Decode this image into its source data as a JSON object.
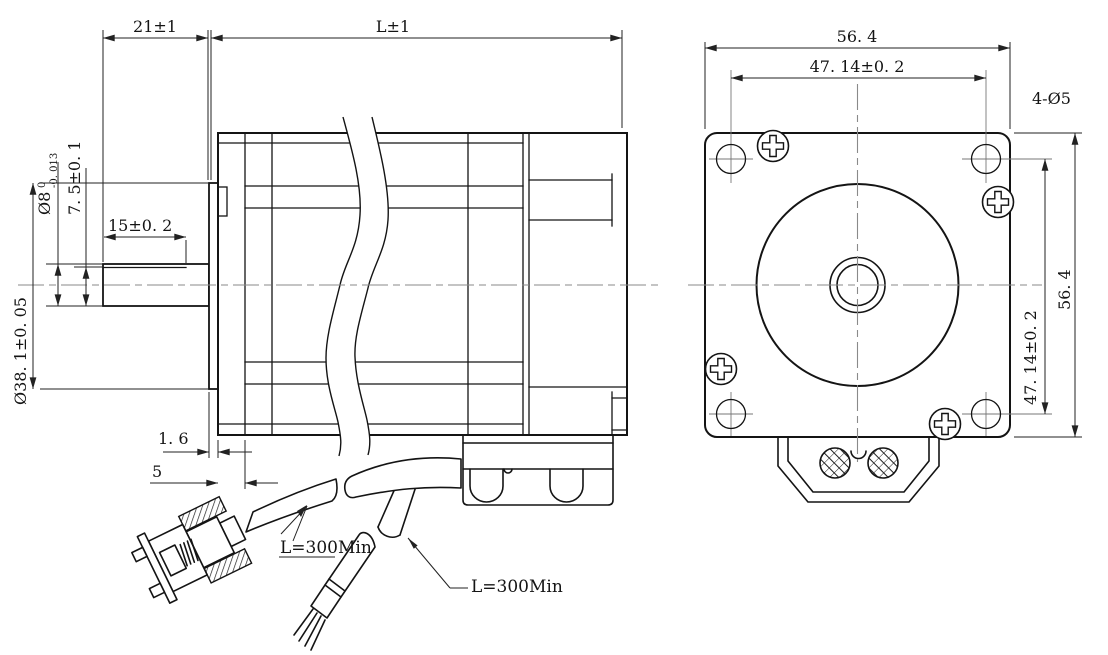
{
  "drawing": {
    "type": "stepper-motor dimensional drawing",
    "colors": {
      "background": "#ffffff",
      "line": "#141414",
      "dimension": "#222222",
      "centerline": "#8a8a8a"
    },
    "side_view": {
      "dim_front_length": "21±1",
      "dim_body_length": "L±1",
      "dim_shaft_dia": "Ø8",
      "dim_shaft_dia_tol_upper": "0",
      "dim_shaft_dia_tol_lower": "-0. 013",
      "dim_flat_height": "7. 5±0. 1",
      "dim_flat_length": "15±0. 2",
      "dim_pilot_dia": "Ø38. 1±0. 05",
      "dim_plate_thickness": "1. 6",
      "dim_boss_depth": "5",
      "label_cable_a": "L=300Min",
      "label_cable_b": "L=300Min"
    },
    "front_view": {
      "dim_width": "56. 4",
      "dim_hole_spacing_top": "47. 14±0. 2",
      "dim_hole_spacing_side": "47. 14±0. 2",
      "dim_height": "56. 4",
      "label_mount_holes": "4-Ø5"
    }
  }
}
